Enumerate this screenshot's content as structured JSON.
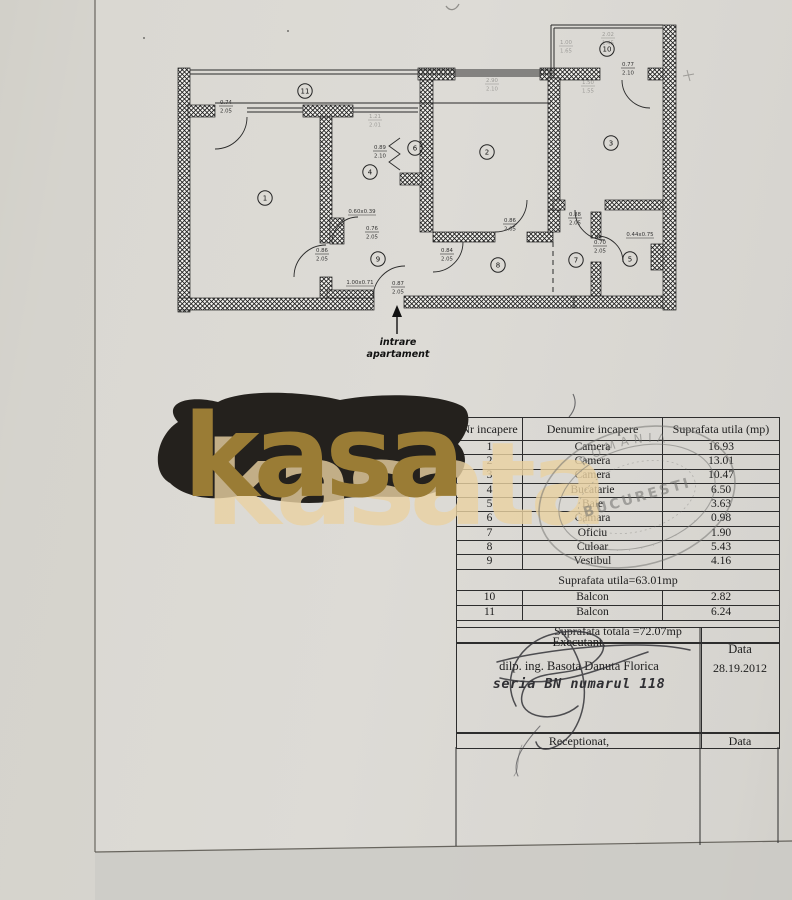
{
  "colors": {
    "paper": "#d8d6d1",
    "ink": "#2d2d2d",
    "stamp_gray": "#71716e",
    "blob_black": "#24211d",
    "gold": "#9a7c35",
    "tan": "#ead2a2"
  },
  "watermark": {
    "dark_text": "kasa",
    "light_text": "kasata"
  },
  "plan": {
    "entrance_line1": "intrare",
    "entrance_line2": "apartament",
    "rooms": [
      [
        "1",
        265,
        198
      ],
      [
        "2",
        487,
        152
      ],
      [
        "3",
        611,
        143
      ],
      [
        "4",
        370,
        172
      ],
      [
        "5",
        630,
        259
      ],
      [
        "6",
        415,
        148
      ],
      [
        "7",
        576,
        260
      ],
      [
        "8",
        498,
        265
      ],
      [
        "9",
        378,
        259
      ],
      [
        "10",
        607,
        49
      ],
      [
        "11",
        305,
        91
      ]
    ],
    "dims": [
      [
        "0.74",
        "2.05",
        226,
        104
      ],
      [
        "0.89",
        "2.10",
        380,
        149
      ],
      [
        "0.76",
        "2.05",
        372,
        230
      ],
      [
        "0.86",
        "2.05",
        322,
        252
      ],
      [
        "0.87",
        "2.05",
        398,
        285
      ],
      [
        "0.84",
        "2.05",
        447,
        252
      ],
      [
        "0.86",
        "2.05",
        510,
        222
      ],
      [
        "0.88",
        "2.05",
        575,
        216
      ],
      [
        "0.70",
        "2.05",
        600,
        244
      ],
      [
        "0.77",
        "2.10",
        628,
        66
      ]
    ],
    "single_dims": [
      [
        "0.60x0.39",
        362,
        213
      ],
      [
        "1.00x0.71",
        360,
        284
      ],
      [
        "0.44x0.75",
        640,
        236
      ]
    ],
    "faint_dims": [
      [
        "1.21",
        "2.01",
        375,
        118
      ],
      [
        "2.90",
        "2.10",
        492,
        82
      ],
      [
        "2.02",
        "1.45",
        608,
        36
      ],
      [
        "1.00",
        "1.65",
        566,
        44
      ],
      [
        "1.50",
        "1.55",
        588,
        84
      ]
    ]
  },
  "table": {
    "headers": [
      "Nr incapere",
      "Denumire incapere",
      "Suprafata utila (mp)"
    ],
    "rows": [
      [
        "1",
        "Camera",
        "16.93"
      ],
      [
        "2",
        "Camera",
        "13.01"
      ],
      [
        "3",
        "Camera",
        "10.47"
      ],
      [
        "4",
        "Bucatarie",
        "6.50"
      ],
      [
        "5",
        "Baie",
        "3.63"
      ],
      [
        "6",
        "Camara",
        "0.98"
      ],
      [
        "7",
        "Oficiu",
        "1.90"
      ],
      [
        "8",
        "Culoar",
        "5.43"
      ],
      [
        "9",
        "Vestibul",
        "4.16"
      ]
    ],
    "subtotal": "Suprafata utila=63.01mp",
    "rows2": [
      [
        "10",
        "Balcon",
        "2.82"
      ],
      [
        "11",
        "Balcon",
        "6.24"
      ]
    ],
    "total": "Suprafata  totala =72.07mp"
  },
  "signoff": {
    "executant_label": "Executant,",
    "executant_name": "dilp. ing. Basota Danuta Florica",
    "executant_series": "seria BN numarul 118",
    "data_label": "Data",
    "date": "28.19.2012",
    "receptionat_label": "Receptionat,",
    "data_label2": "Data"
  },
  "stamp": {
    "top_text": "ROMANIA",
    "center_text": "BUCURESTI"
  }
}
